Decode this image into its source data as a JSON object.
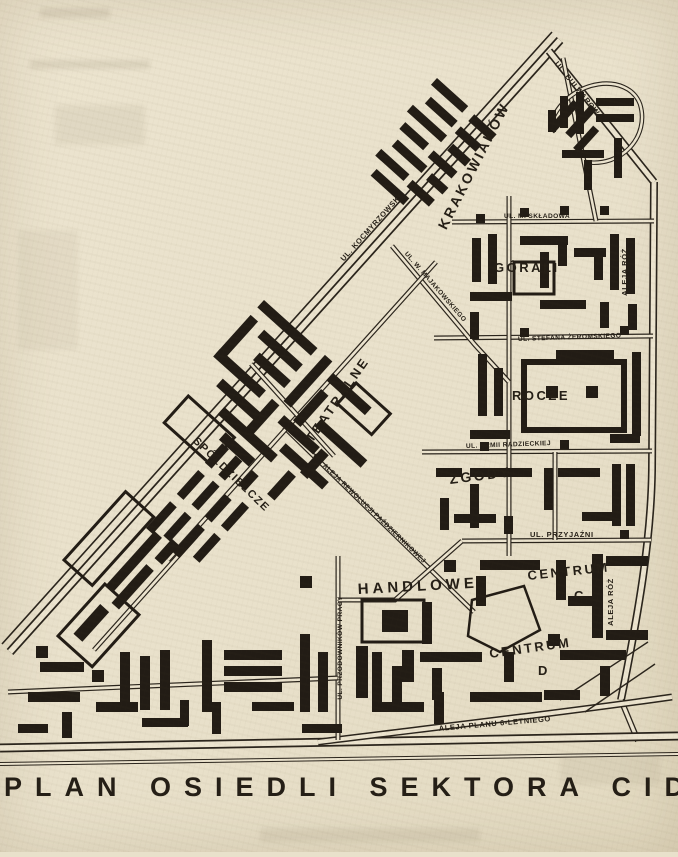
{
  "page": {
    "title": "PLAN OSIEDLI SEKTORA CID.",
    "paper_color": "#e9e1cb",
    "ink_color": "#241e16"
  },
  "map": {
    "districts": {
      "krakowiakow": "KRAKOWIAKÓW",
      "gorali": "GÓRALI",
      "teatralne": "TEATRALNE",
      "urocze": "ROCZE",
      "zgody": "ZGODY",
      "spoldzielcze": "SPÓŁDZIELCZE",
      "handlowe": "HANDLOWE",
      "centrum_c": "CENTRUM",
      "centrum_c_letter": "C",
      "centrum_d": "CENTRUM",
      "centrum_d_letter": "D"
    },
    "streets": {
      "kocmyrzowska": "UL. KOCMYRZOWSKA",
      "bulwarowa": "UL. BULWAROWA",
      "aleja_roz": "ALEJA RÓŻ",
      "skladowa": "UL. M. SKŁADOWA",
      "zeromskiego": "UL. STEFANA ŻEROMSKIEGO",
      "majakowskiego": "UL. W. MAJAKOWSKIEGO",
      "armii_radzieckiej": "UL. ARMII RADZIECKIEJ",
      "przyjazni": "UL. PRZYJAŹNI",
      "rewolucji": "UL. ALEJA REWOLUCJI PAŹDZIERNIKOWEJ",
      "przodownikow": "UL. PRZODOWNIKÓW PRACY",
      "planu_6": "ALEJA PLANU 6-LETNIEGO"
    }
  }
}
